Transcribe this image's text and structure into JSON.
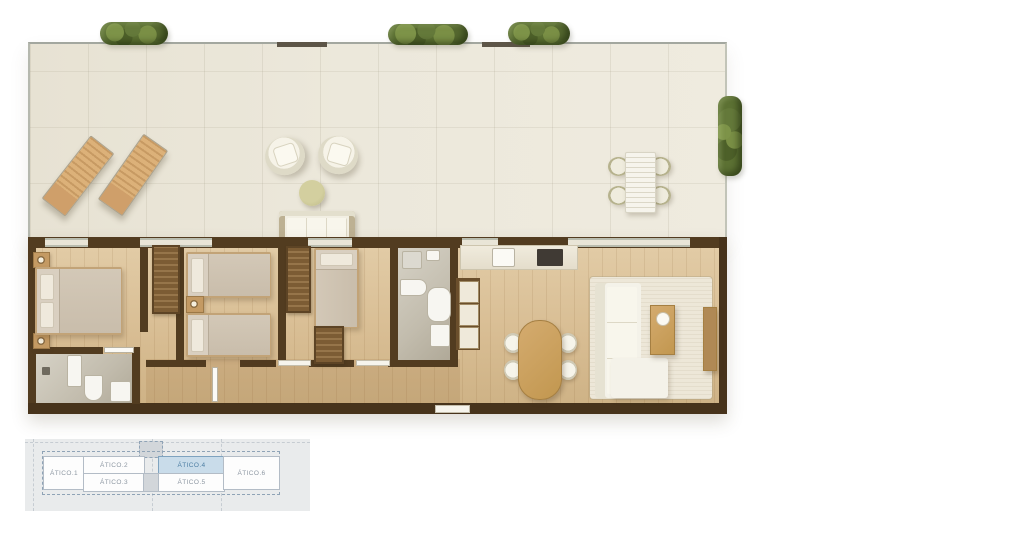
{
  "page": {
    "background_color": "#ffffff"
  },
  "floorplan": {
    "kind": "apartment-floor-plan-render",
    "unit_name": "ÁTICO.4",
    "areas": {
      "terrace": [
        "sun-lounger",
        "sun-lounger",
        "armchair",
        "armchair",
        "side-table",
        "outdoor-sofa",
        "outdoor-dining-table",
        "outdoor-chairs",
        "planters"
      ],
      "interior": [
        "master-bedroom",
        "ensuite-bathroom",
        "twin-bedroom",
        "single-bedroom",
        "bathroom",
        "hallway",
        "kitchen",
        "dining-area",
        "living-room"
      ]
    },
    "colors": {
      "terrace_floor": "#ece8db",
      "interior_floor": "#d8bd93",
      "wall": "#523c20",
      "plant_green": "#5c7133",
      "furniture_cream": "#f4f2e9",
      "wood_furniture": "#cfa569"
    }
  },
  "keyplan": {
    "units": [
      {
        "label": "ÁTICO.1",
        "highlighted": false
      },
      {
        "label": "ÁTICO.2",
        "highlighted": false
      },
      {
        "label": "ÁTICO.3",
        "highlighted": false
      },
      {
        "label": "ÁTICO.4",
        "highlighted": true
      },
      {
        "label": "ÁTICO.5",
        "highlighted": false
      },
      {
        "label": "ÁTICO.6",
        "highlighted": false
      }
    ],
    "highlight_fill": "#c9dcea",
    "highlight_text": "#4d7ea3",
    "label_text": "#8d97a2",
    "panel_background": "#e9ebec"
  }
}
